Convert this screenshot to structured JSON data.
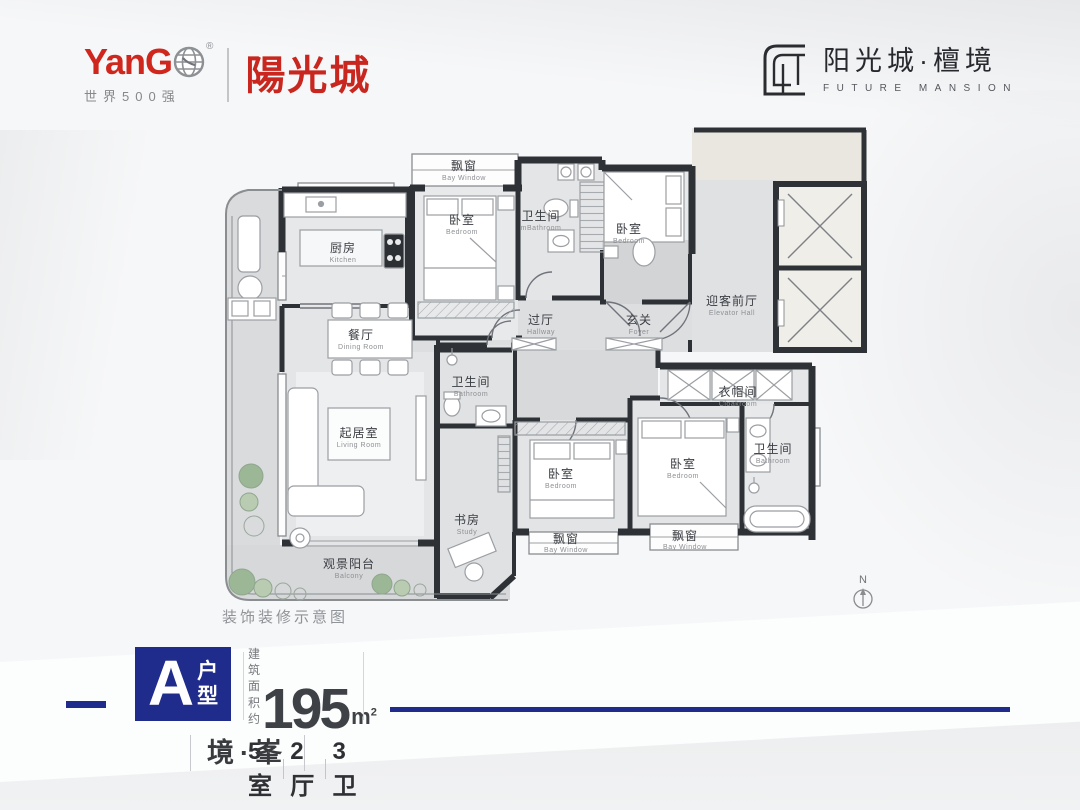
{
  "header": {
    "yango_logo": {
      "wordmark": "YanG",
      "registered_mark": "®",
      "subtitle": "世界500强",
      "calligraphy_name": "陽光城"
    },
    "brand_logo": {
      "name": "阳光城·檀境",
      "subtitle": "FUTURE MANSION"
    }
  },
  "plan": {
    "caption": "装饰装修示意图",
    "north_label": "N",
    "rooms": [
      {
        "zh": "飘窗",
        "en": "Bay Window"
      },
      {
        "zh": "卧室",
        "en": "Bedroom"
      },
      {
        "zh": "卫生间",
        "en": "mBathroom"
      },
      {
        "zh": "卧室",
        "en": "Bedroom"
      },
      {
        "zh": "厨房",
        "en": "Kitchen"
      },
      {
        "zh": "餐厅",
        "en": "Dining Room"
      },
      {
        "zh": "过厅",
        "en": "Hallway"
      },
      {
        "zh": "玄关",
        "en": "Foyer"
      },
      {
        "zh": "迎客前厅",
        "en": "Elevator Hall"
      },
      {
        "zh": "卫生间",
        "en": "Bathroom"
      },
      {
        "zh": "起居室",
        "en": "Living Room"
      },
      {
        "zh": "书房",
        "en": "Study"
      },
      {
        "zh": "卧室",
        "en": "Bedroom"
      },
      {
        "zh": "卧室",
        "en": "Bedroom"
      },
      {
        "zh": "衣帽间",
        "en": "Cloakroom"
      },
      {
        "zh": "卫生间",
        "en": "Bathroom"
      },
      {
        "zh": "飘窗",
        "en": "Bay Window"
      },
      {
        "zh": "飘窗",
        "en": "Bay Window"
      },
      {
        "zh": "观景阳台",
        "en": "Balcony"
      }
    ]
  },
  "info": {
    "unit_letter": "A",
    "unit_label_line1": "户",
    "unit_label_line2": "型",
    "area_prefix_line1": "建筑",
    "area_prefix_line2": "面积约",
    "area_value": "195",
    "area_unit": "m",
    "area_unit_exponent": "2",
    "layout_bedrooms": "5室",
    "layout_livingrooms": "2厅",
    "layout_bathrooms": "3卫",
    "tagline": "境·峯"
  },
  "colors": {
    "accent_blue": "#202c8c",
    "logo_red": "#cf261d"
  }
}
